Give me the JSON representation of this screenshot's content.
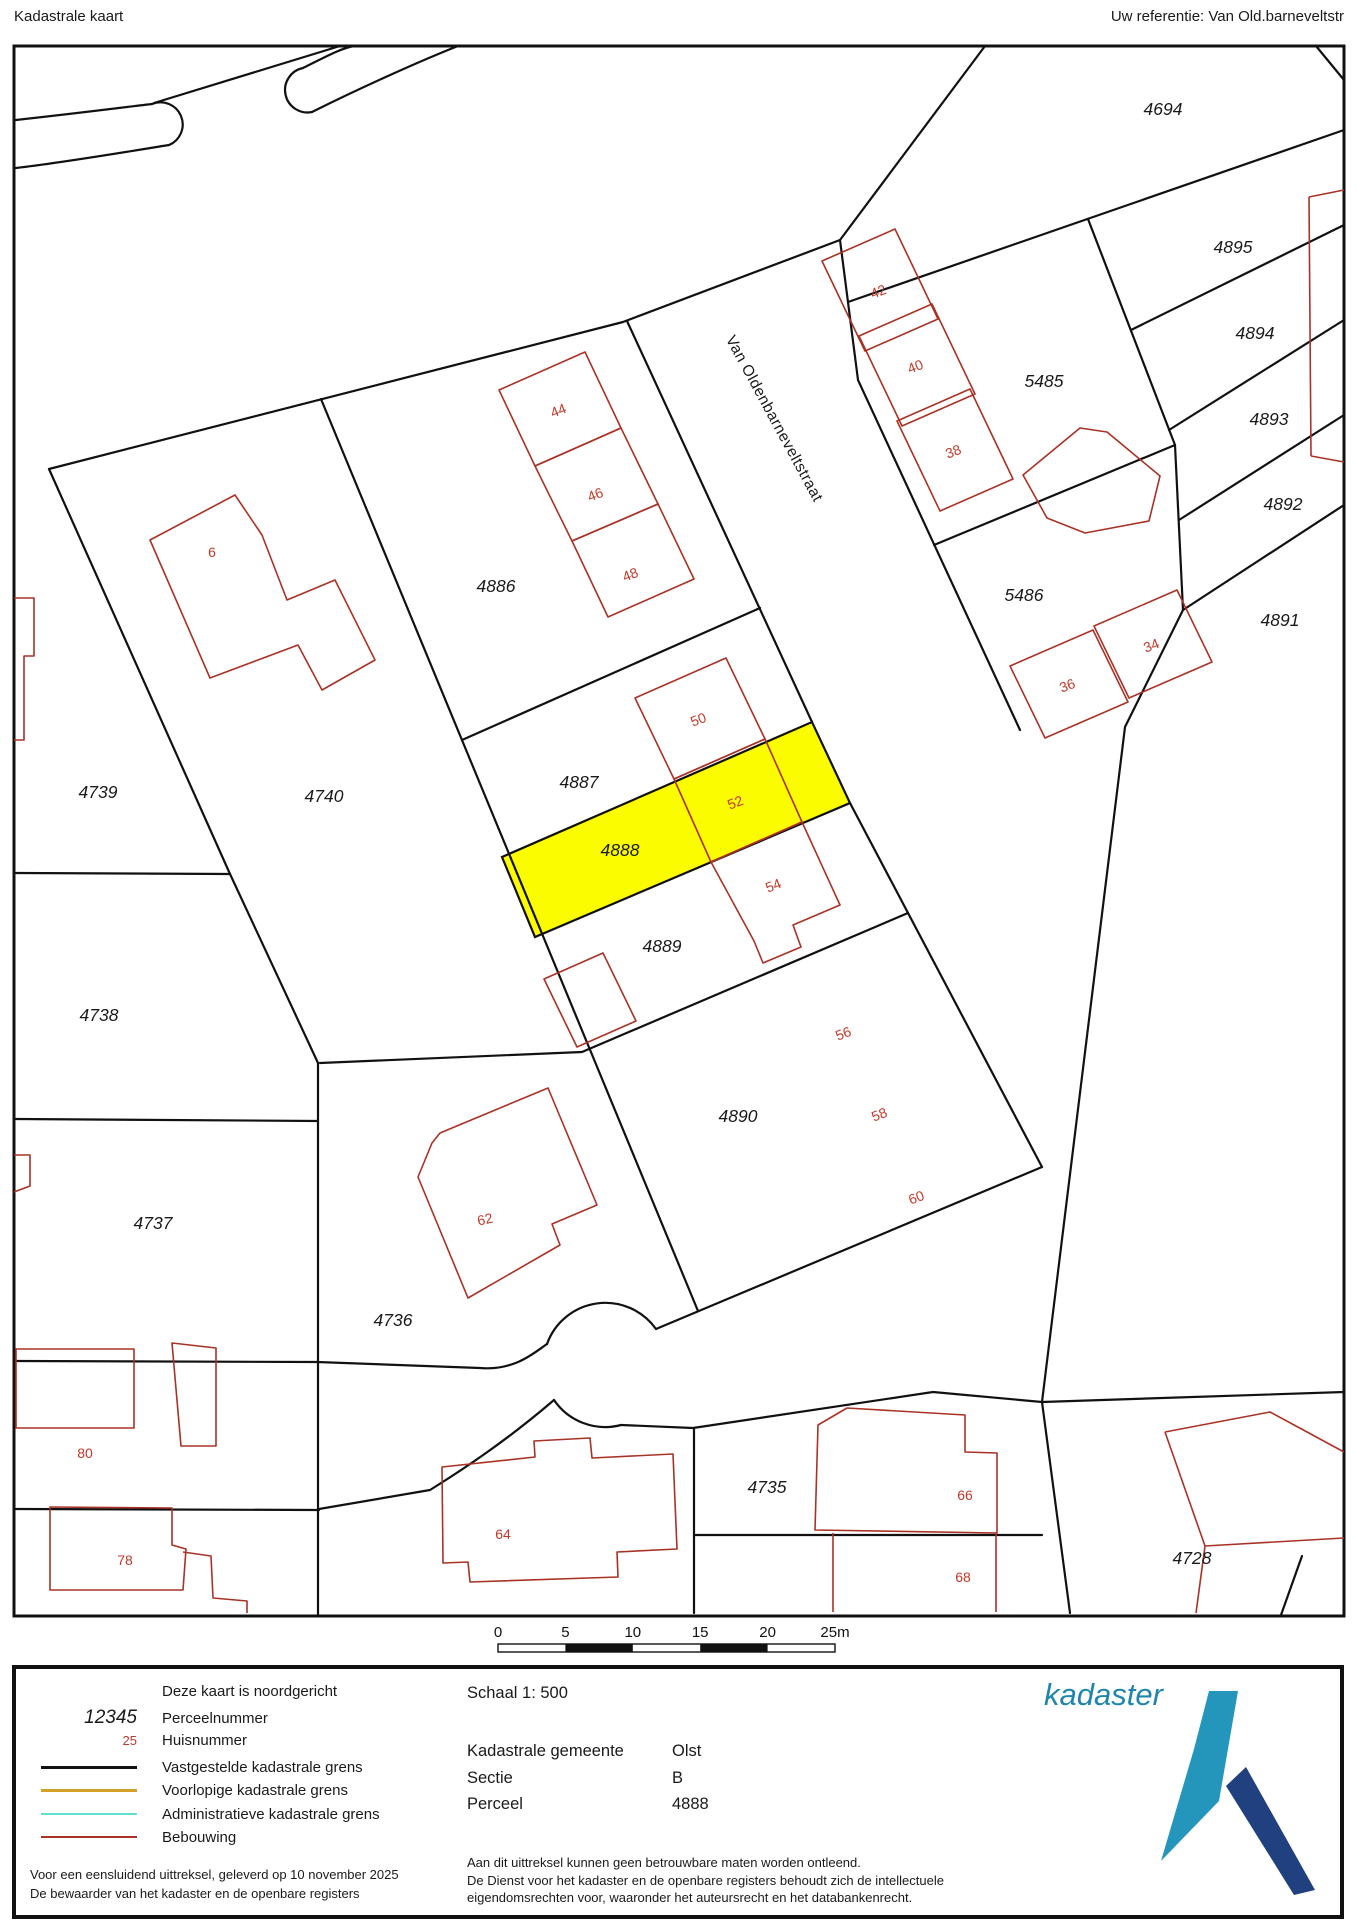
{
  "header": {
    "title": "Kadastrale kaart",
    "reference": "Uw referentie: Van Old.barneveltstr"
  },
  "map": {
    "street_name": "Van Oldenbarneveltstraat",
    "colors": {
      "highlight": "#FCFC00",
      "boundary": "#111111",
      "building": "#A93226",
      "house_number": "#C03A2B"
    },
    "highlighted_parcel": "4888",
    "parcels": [
      {
        "text": "4694",
        "x": 1163,
        "y": 115
      },
      {
        "text": "4895",
        "x": 1233,
        "y": 253
      },
      {
        "text": "4894",
        "x": 1255,
        "y": 339
      },
      {
        "text": "5485",
        "x": 1044,
        "y": 387
      },
      {
        "text": "4893",
        "x": 1269,
        "y": 425
      },
      {
        "text": "4892",
        "x": 1283,
        "y": 510
      },
      {
        "text": "4891",
        "x": 1280,
        "y": 626
      },
      {
        "text": "4886",
        "x": 496,
        "y": 592
      },
      {
        "text": "4739",
        "x": 98,
        "y": 798
      },
      {
        "text": "4740",
        "x": 324,
        "y": 802
      },
      {
        "text": "4887",
        "x": 579,
        "y": 788
      },
      {
        "text": "4888",
        "x": 620,
        "y": 856
      },
      {
        "text": "4889",
        "x": 662,
        "y": 952
      },
      {
        "text": "4738",
        "x": 99,
        "y": 1021
      },
      {
        "text": "5486",
        "x": 1024,
        "y": 601
      },
      {
        "text": "4890",
        "x": 738,
        "y": 1122
      },
      {
        "text": "4737",
        "x": 153,
        "y": 1229
      },
      {
        "text": "4736",
        "x": 393,
        "y": 1326
      },
      {
        "text": "4735",
        "x": 767,
        "y": 1493
      },
      {
        "text": "4728",
        "x": 1192,
        "y": 1564
      }
    ],
    "houses": [
      {
        "text": "6",
        "x": 212,
        "y": 557,
        "rot": 0
      },
      {
        "text": "44",
        "x": 560,
        "y": 415,
        "rot": -21
      },
      {
        "text": "46",
        "x": 597,
        "y": 499,
        "rot": -21
      },
      {
        "text": "48",
        "x": 632,
        "y": 579,
        "rot": -21
      },
      {
        "text": "50",
        "x": 700,
        "y": 724,
        "rot": -21
      },
      {
        "text": "52",
        "x": 737,
        "y": 807,
        "rot": -21
      },
      {
        "text": "54",
        "x": 775,
        "y": 890,
        "rot": -21
      },
      {
        "text": "42",
        "x": 880,
        "y": 296,
        "rot": -21
      },
      {
        "text": "40",
        "x": 917,
        "y": 371,
        "rot": -21
      },
      {
        "text": "38",
        "x": 955,
        "y": 456,
        "rot": -21
      },
      {
        "text": "36",
        "x": 1069,
        "y": 690,
        "rot": -21
      },
      {
        "text": "34",
        "x": 1153,
        "y": 650,
        "rot": -21
      },
      {
        "text": "56",
        "x": 845,
        "y": 1038,
        "rot": -21
      },
      {
        "text": "58",
        "x": 881,
        "y": 1119,
        "rot": -21
      },
      {
        "text": "60",
        "x": 918,
        "y": 1202,
        "rot": -21
      },
      {
        "text": "62",
        "x": 486,
        "y": 1224,
        "rot": -12
      },
      {
        "text": "80",
        "x": 85,
        "y": 1458,
        "rot": 0
      },
      {
        "text": "78",
        "x": 125,
        "y": 1565,
        "rot": 0
      },
      {
        "text": "64",
        "x": 503,
        "y": 1539,
        "rot": 0
      },
      {
        "text": "66",
        "x": 965,
        "y": 1500,
        "rot": 0
      },
      {
        "text": "68",
        "x": 963,
        "y": 1582,
        "rot": 0
      }
    ]
  },
  "scalebar": {
    "labels": [
      "0",
      "5",
      "10",
      "15",
      "20",
      "25m"
    ]
  },
  "legend": {
    "items": [
      {
        "type": "none",
        "sample": "",
        "color": "",
        "thickness": 0,
        "label": "Deze kaart is noordgericht"
      },
      {
        "type": "parcel",
        "sample": "12345",
        "color": "#1a1a1a",
        "thickness": 0,
        "label": "Perceelnummer"
      },
      {
        "type": "house",
        "sample": "25",
        "color": "#C03A2B",
        "thickness": 0,
        "label": "Huisnummer"
      },
      {
        "type": "line",
        "sample": "",
        "color": "#111111",
        "thickness": 3,
        "label": "Vastgestelde kadastrale grens"
      },
      {
        "type": "line",
        "sample": "",
        "color": "#D4A02A",
        "thickness": 3,
        "label": "Voorlopige kadastrale grens"
      },
      {
        "type": "line",
        "sample": "",
        "color": "#5FE0D0",
        "thickness": 2.5,
        "label": "Administratieve kadastrale grens"
      },
      {
        "type": "line",
        "sample": "",
        "color": "#A93226",
        "thickness": 2,
        "label": "Bebouwing"
      }
    ]
  },
  "details": {
    "schaal": "Schaal 1: 500",
    "rows": [
      {
        "label": "Kadastrale gemeente",
        "value": "Olst"
      },
      {
        "label": "Sectie",
        "value": "B"
      },
      {
        "label": "Perceel",
        "value": "4888"
      }
    ]
  },
  "footer_left": {
    "line1": "Voor een eensluidend uittreksel, geleverd op 10 november 2025",
    "line2": "De bewaarder van het kadaster en de openbare registers"
  },
  "footer_right": {
    "line1": "Aan dit uittreksel kunnen geen betrouwbare maten worden ontleend.",
    "line2": "De Dienst voor het kadaster en de openbare registers behoudt zich de intellectuele",
    "line3": "eigendomsrechten voor, waaronder het auteursrecht en het databankenrecht.",
    "line0": ""
  },
  "logo": {
    "text": "kadaster"
  }
}
